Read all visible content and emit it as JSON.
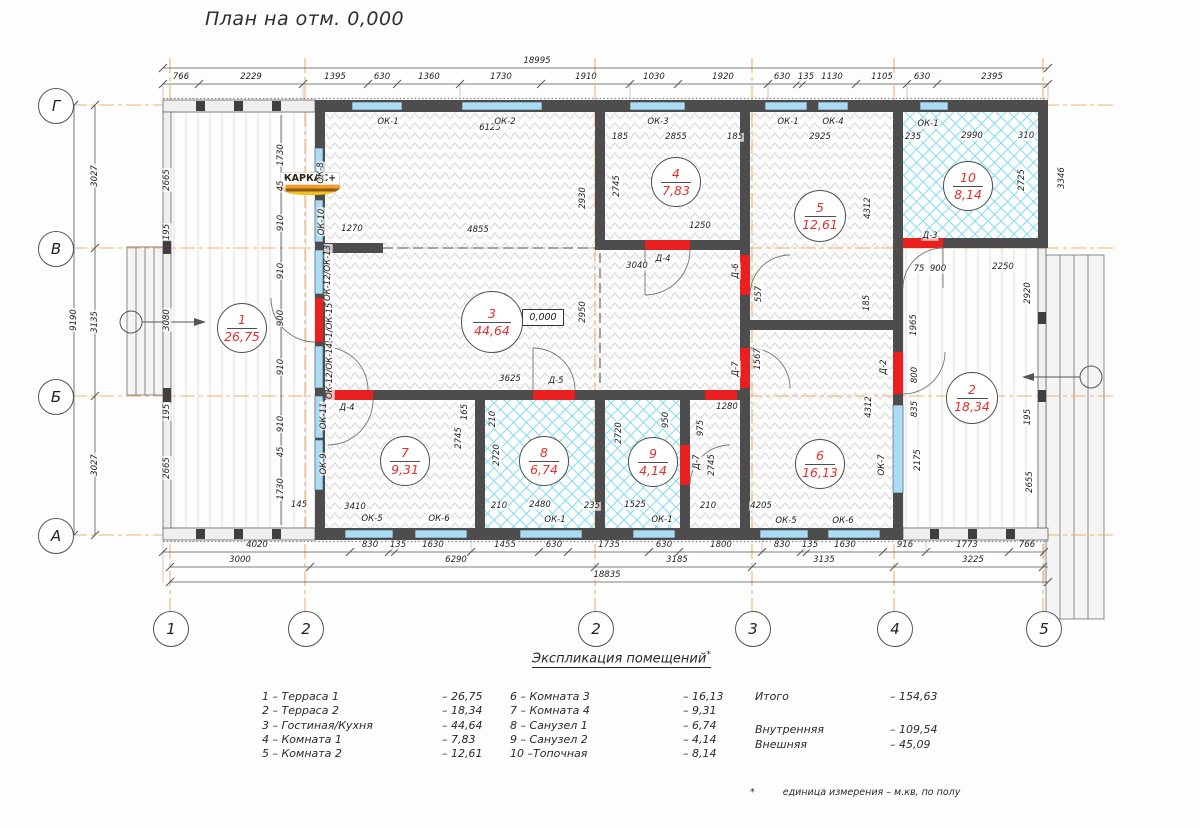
{
  "title": "План на отм. 0,000",
  "logo": "КАРКАС+",
  "elevation_mark": "0,000",
  "colors": {
    "axis": "#f1a85f",
    "wall": "#4d4d4d",
    "window": "#abdcf5",
    "door": "#ea2020",
    "room_text": "#e03030",
    "wet_hatch": "#89dcee"
  },
  "axes": {
    "rows": [
      {
        "label": "Г",
        "y": 105
      },
      {
        "label": "В",
        "y": 248
      },
      {
        "label": "Б",
        "y": 396
      },
      {
        "label": "А",
        "y": 535
      }
    ],
    "cols": [
      {
        "label": "1",
        "x": 170
      },
      {
        "label": "2",
        "x": 305
      },
      {
        "label": "2",
        "x": 595
      },
      {
        "label": "3",
        "x": 752
      },
      {
        "label": "4",
        "x": 894
      },
      {
        "label": "5",
        "x": 1043
      }
    ]
  },
  "rooms": [
    {
      "num": "1",
      "area": "26,75",
      "x": 242,
      "y": 328,
      "d": 50
    },
    {
      "num": "2",
      "area": "18,34",
      "x": 972,
      "y": 398,
      "d": 52
    },
    {
      "num": "3",
      "area": "44,64",
      "x": 492,
      "y": 322,
      "d": 62
    },
    {
      "num": "4",
      "area": "7,83",
      "x": 676,
      "y": 182,
      "d": 50
    },
    {
      "num": "5",
      "area": "12,61",
      "x": 820,
      "y": 216,
      "d": 52
    },
    {
      "num": "6",
      "area": "16,13",
      "x": 820,
      "y": 464,
      "d": 50
    },
    {
      "num": "7",
      "area": "9,31",
      "x": 405,
      "y": 461,
      "d": 50
    },
    {
      "num": "8",
      "area": "6,74",
      "x": 544,
      "y": 461,
      "d": 50
    },
    {
      "num": "9",
      "area": "4,14",
      "x": 653,
      "y": 462,
      "d": 50
    },
    {
      "num": "10",
      "area": "8,14",
      "x": 968,
      "y": 186,
      "d": 50
    }
  ],
  "dims": [
    {
      "t": "18995",
      "x": 537,
      "y": 61
    },
    {
      "t": "766",
      "x": 181,
      "y": 77
    },
    {
      "t": "2229",
      "x": 251,
      "y": 77
    },
    {
      "t": "1395",
      "x": 335,
      "y": 77
    },
    {
      "t": "630",
      "x": 382,
      "y": 77
    },
    {
      "t": "1360",
      "x": 429,
      "y": 77
    },
    {
      "t": "1730",
      "x": 501,
      "y": 77
    },
    {
      "t": "1910",
      "x": 586,
      "y": 77
    },
    {
      "t": "1030",
      "x": 654,
      "y": 77
    },
    {
      "t": "1920",
      "x": 723,
      "y": 77
    },
    {
      "t": "630",
      "x": 782,
      "y": 77
    },
    {
      "t": "135",
      "x": 806,
      "y": 77
    },
    {
      "t": "1130",
      "x": 832,
      "y": 77
    },
    {
      "t": "1105",
      "x": 882,
      "y": 77
    },
    {
      "t": "630",
      "x": 922,
      "y": 77
    },
    {
      "t": "2395",
      "x": 992,
      "y": 77
    },
    {
      "t": "4020",
      "x": 257,
      "y": 545
    },
    {
      "t": "830",
      "x": 370,
      "y": 545
    },
    {
      "t": "135",
      "x": 398,
      "y": 545
    },
    {
      "t": "1630",
      "x": 433,
      "y": 545
    },
    {
      "t": "1455",
      "x": 505,
      "y": 545
    },
    {
      "t": "630",
      "x": 554,
      "y": 545
    },
    {
      "t": "1735",
      "x": 609,
      "y": 545
    },
    {
      "t": "630",
      "x": 664,
      "y": 545
    },
    {
      "t": "1800",
      "x": 721,
      "y": 545
    },
    {
      "t": "830",
      "x": 782,
      "y": 545
    },
    {
      "t": "135",
      "x": 810,
      "y": 545
    },
    {
      "t": "1630",
      "x": 845,
      "y": 545
    },
    {
      "t": "916",
      "x": 905,
      "y": 545
    },
    {
      "t": "1773",
      "x": 967,
      "y": 545
    },
    {
      "t": "766",
      "x": 1027,
      "y": 545
    },
    {
      "t": "3000",
      "x": 240,
      "y": 560
    },
    {
      "t": "6290",
      "x": 456,
      "y": 560
    },
    {
      "t": "3185",
      "x": 677,
      "y": 560
    },
    {
      "t": "3135",
      "x": 824,
      "y": 560
    },
    {
      "t": "3225",
      "x": 973,
      "y": 560
    },
    {
      "t": "18835",
      "x": 607,
      "y": 575
    },
    {
      "t": "3027",
      "x": 95,
      "y": 176,
      "r": 1
    },
    {
      "t": "3135",
      "x": 95,
      "y": 322,
      "r": 1
    },
    {
      "t": "3027",
      "x": 95,
      "y": 465,
      "r": 1
    },
    {
      "t": "9190",
      "x": 74,
      "y": 320,
      "r": 1
    },
    {
      "t": "2665",
      "x": 167,
      "y": 180,
      "r": 1
    },
    {
      "t": "195",
      "x": 167,
      "y": 232,
      "r": 1
    },
    {
      "t": "3080",
      "x": 167,
      "y": 320,
      "r": 1
    },
    {
      "t": "195",
      "x": 167,
      "y": 412,
      "r": 1
    },
    {
      "t": "2665",
      "x": 167,
      "y": 468,
      "r": 1
    },
    {
      "t": "1730",
      "x": 281,
      "y": 155,
      "r": 1
    },
    {
      "t": "45",
      "x": 281,
      "y": 186,
      "r": 1
    },
    {
      "t": "910",
      "x": 281,
      "y": 223,
      "r": 1
    },
    {
      "t": "910",
      "x": 281,
      "y": 271,
      "r": 1
    },
    {
      "t": "900",
      "x": 281,
      "y": 318,
      "r": 1
    },
    {
      "t": "910",
      "x": 281,
      "y": 367,
      "r": 1
    },
    {
      "t": "910",
      "x": 281,
      "y": 424,
      "r": 1
    },
    {
      "t": "45",
      "x": 281,
      "y": 452,
      "r": 1
    },
    {
      "t": "1730",
      "x": 281,
      "y": 489,
      "r": 1
    },
    {
      "t": "145",
      "x": 299,
      "y": 505
    },
    {
      "t": "6125",
      "x": 490,
      "y": 128
    },
    {
      "t": "1270",
      "x": 352,
      "y": 229
    },
    {
      "t": "4855",
      "x": 478,
      "y": 230
    },
    {
      "t": "2930",
      "x": 583,
      "y": 198,
      "r": 1
    },
    {
      "t": "2950",
      "x": 583,
      "y": 312,
      "r": 1
    },
    {
      "t": "3625",
      "x": 510,
      "y": 379
    },
    {
      "t": "3040",
      "x": 637,
      "y": 266
    },
    {
      "t": "185",
      "x": 620,
      "y": 137
    },
    {
      "t": "2855",
      "x": 676,
      "y": 137
    },
    {
      "t": "185",
      "x": 735,
      "y": 137
    },
    {
      "t": "2745",
      "x": 617,
      "y": 186,
      "r": 1
    },
    {
      "t": "1250",
      "x": 700,
      "y": 226
    },
    {
      "t": "2925",
      "x": 820,
      "y": 137
    },
    {
      "t": "4312",
      "x": 868,
      "y": 208,
      "r": 1
    },
    {
      "t": "185",
      "x": 867,
      "y": 303,
      "r": 1
    },
    {
      "t": "557",
      "x": 759,
      "y": 294,
      "r": 1
    },
    {
      "t": "1567",
      "x": 758,
      "y": 359,
      "r": 1
    },
    {
      "t": "1280",
      "x": 727,
      "y": 407
    },
    {
      "t": "235",
      "x": 913,
      "y": 137
    },
    {
      "t": "2990",
      "x": 972,
      "y": 136
    },
    {
      "t": "310",
      "x": 1026,
      "y": 136
    },
    {
      "t": "2725",
      "x": 1022,
      "y": 180,
      "r": 1
    },
    {
      "t": "3346",
      "x": 1062,
      "y": 178,
      "r": 1
    },
    {
      "t": "75",
      "x": 919,
      "y": 269
    },
    {
      "t": "900",
      "x": 938,
      "y": 269
    },
    {
      "t": "2250",
      "x": 1003,
      "y": 267
    },
    {
      "t": "2920",
      "x": 1028,
      "y": 293,
      "r": 1
    },
    {
      "t": "1965",
      "x": 914,
      "y": 325,
      "r": 1
    },
    {
      "t": "800",
      "x": 915,
      "y": 375,
      "r": 1
    },
    {
      "t": "835",
      "x": 915,
      "y": 409,
      "r": 1
    },
    {
      "t": "195",
      "x": 1028,
      "y": 417,
      "r": 1
    },
    {
      "t": "2175",
      "x": 918,
      "y": 460,
      "r": 1
    },
    {
      "t": "2655",
      "x": 1030,
      "y": 482,
      "r": 1
    },
    {
      "t": "4312",
      "x": 869,
      "y": 407,
      "r": 1
    },
    {
      "t": "975",
      "x": 701,
      "y": 428,
      "r": 1
    },
    {
      "t": "950",
      "x": 666,
      "y": 420,
      "r": 1
    },
    {
      "t": "2745",
      "x": 712,
      "y": 465,
      "r": 1
    },
    {
      "t": "4205",
      "x": 761,
      "y": 506
    },
    {
      "t": "210",
      "x": 708,
      "y": 506
    },
    {
      "t": "165",
      "x": 465,
      "y": 412,
      "r": 1
    },
    {
      "t": "2745",
      "x": 459,
      "y": 438,
      "r": 1
    },
    {
      "t": "3410",
      "x": 355,
      "y": 507
    },
    {
      "t": "210",
      "x": 493,
      "y": 419,
      "r": 1
    },
    {
      "t": "2720",
      "x": 497,
      "y": 455,
      "r": 1
    },
    {
      "t": "210",
      "x": 499,
      "y": 506
    },
    {
      "t": "2480",
      "x": 540,
      "y": 505
    },
    {
      "t": "235",
      "x": 592,
      "y": 506
    },
    {
      "t": "2720",
      "x": 619,
      "y": 433,
      "r": 1
    },
    {
      "t": "1525",
      "x": 635,
      "y": 505
    }
  ],
  "openings": [
    {
      "t": "ОК-1",
      "x": 388,
      "y": 122
    },
    {
      "t": "ОК-2",
      "x": 505,
      "y": 122
    },
    {
      "t": "ОК-3",
      "x": 658,
      "y": 122
    },
    {
      "t": "ОК-1",
      "x": 788,
      "y": 122
    },
    {
      "t": "ОК-4",
      "x": 833,
      "y": 122
    },
    {
      "t": "ОК-1",
      "x": 928,
      "y": 124
    },
    {
      "t": "ОК-8",
      "x": 321,
      "y": 173,
      "r": 1
    },
    {
      "t": "ОК-10",
      "x": 322,
      "y": 222,
      "r": 1
    },
    {
      "t": "ОК-12/ОК-13",
      "x": 328,
      "y": 273,
      "r": 1
    },
    {
      "t": "Д-1/ОК-15",
      "x": 330,
      "y": 325,
      "r": 1
    },
    {
      "t": "ОК-12/ОК-14",
      "x": 330,
      "y": 371,
      "r": 1
    },
    {
      "t": "ОК-11",
      "x": 324,
      "y": 416,
      "r": 1
    },
    {
      "t": "ОК-9",
      "x": 324,
      "y": 464,
      "r": 1
    },
    {
      "t": "Д-4",
      "x": 663,
      "y": 259
    },
    {
      "t": "Д-6",
      "x": 736,
      "y": 271,
      "r": 1
    },
    {
      "t": "Д-7",
      "x": 736,
      "y": 369,
      "r": 1
    },
    {
      "t": "Д-5",
      "x": 556,
      "y": 381
    },
    {
      "t": "Д-4",
      "x": 347,
      "y": 408
    },
    {
      "t": "Д-3",
      "x": 930,
      "y": 236
    },
    {
      "t": "Д-2",
      "x": 884,
      "y": 367,
      "r": 1
    },
    {
      "t": "ОК-7",
      "x": 882,
      "y": 465,
      "r": 1
    },
    {
      "t": "Д-7",
      "x": 697,
      "y": 462,
      "r": 1
    },
    {
      "t": "ОК-5",
      "x": 372,
      "y": 519
    },
    {
      "t": "ОК-6",
      "x": 439,
      "y": 519
    },
    {
      "t": "ОК-1",
      "x": 555,
      "y": 520
    },
    {
      "t": "ОК-1",
      "x": 662,
      "y": 520
    },
    {
      "t": "ОК-5",
      "x": 786,
      "y": 521
    },
    {
      "t": "ОК-6",
      "x": 843,
      "y": 521
    }
  ],
  "legend": {
    "title": "Экспликация помещений",
    "title_mark": "*",
    "col1": [
      {
        "label": "1 – Терраса 1",
        "value": "– 26,75"
      },
      {
        "label": "2 – Терраса 2",
        "value": "– 18,34"
      },
      {
        "label": "3 – Гостиная/Кухня",
        "value": "– 44,64"
      },
      {
        "label": "4 – Комната 1",
        "value": "– 7,83"
      },
      {
        "label": "5 – Комната 2",
        "value": "– 12,61"
      }
    ],
    "col2": [
      {
        "label": "6 – Комната 3",
        "value": "– 16,13"
      },
      {
        "label": "7 – Комната 4",
        "value": "– 9,31"
      },
      {
        "label": "8 – Санузел 1",
        "value": "– 6,74"
      },
      {
        "label": "9 – Санузел 2",
        "value": "– 4,14"
      },
      {
        "label": "10 –Топочная",
        "value": "– 8,14"
      }
    ],
    "totals": [
      {
        "label": "Итого",
        "value": "– 154,63"
      },
      {
        "label": "Внутренняя",
        "value": "– 109,54"
      },
      {
        "label": "Внешняя",
        "value": "– 45,09"
      }
    ],
    "footnote_mark": "*",
    "footnote": "единица измерения – м.кв,  по полу"
  }
}
